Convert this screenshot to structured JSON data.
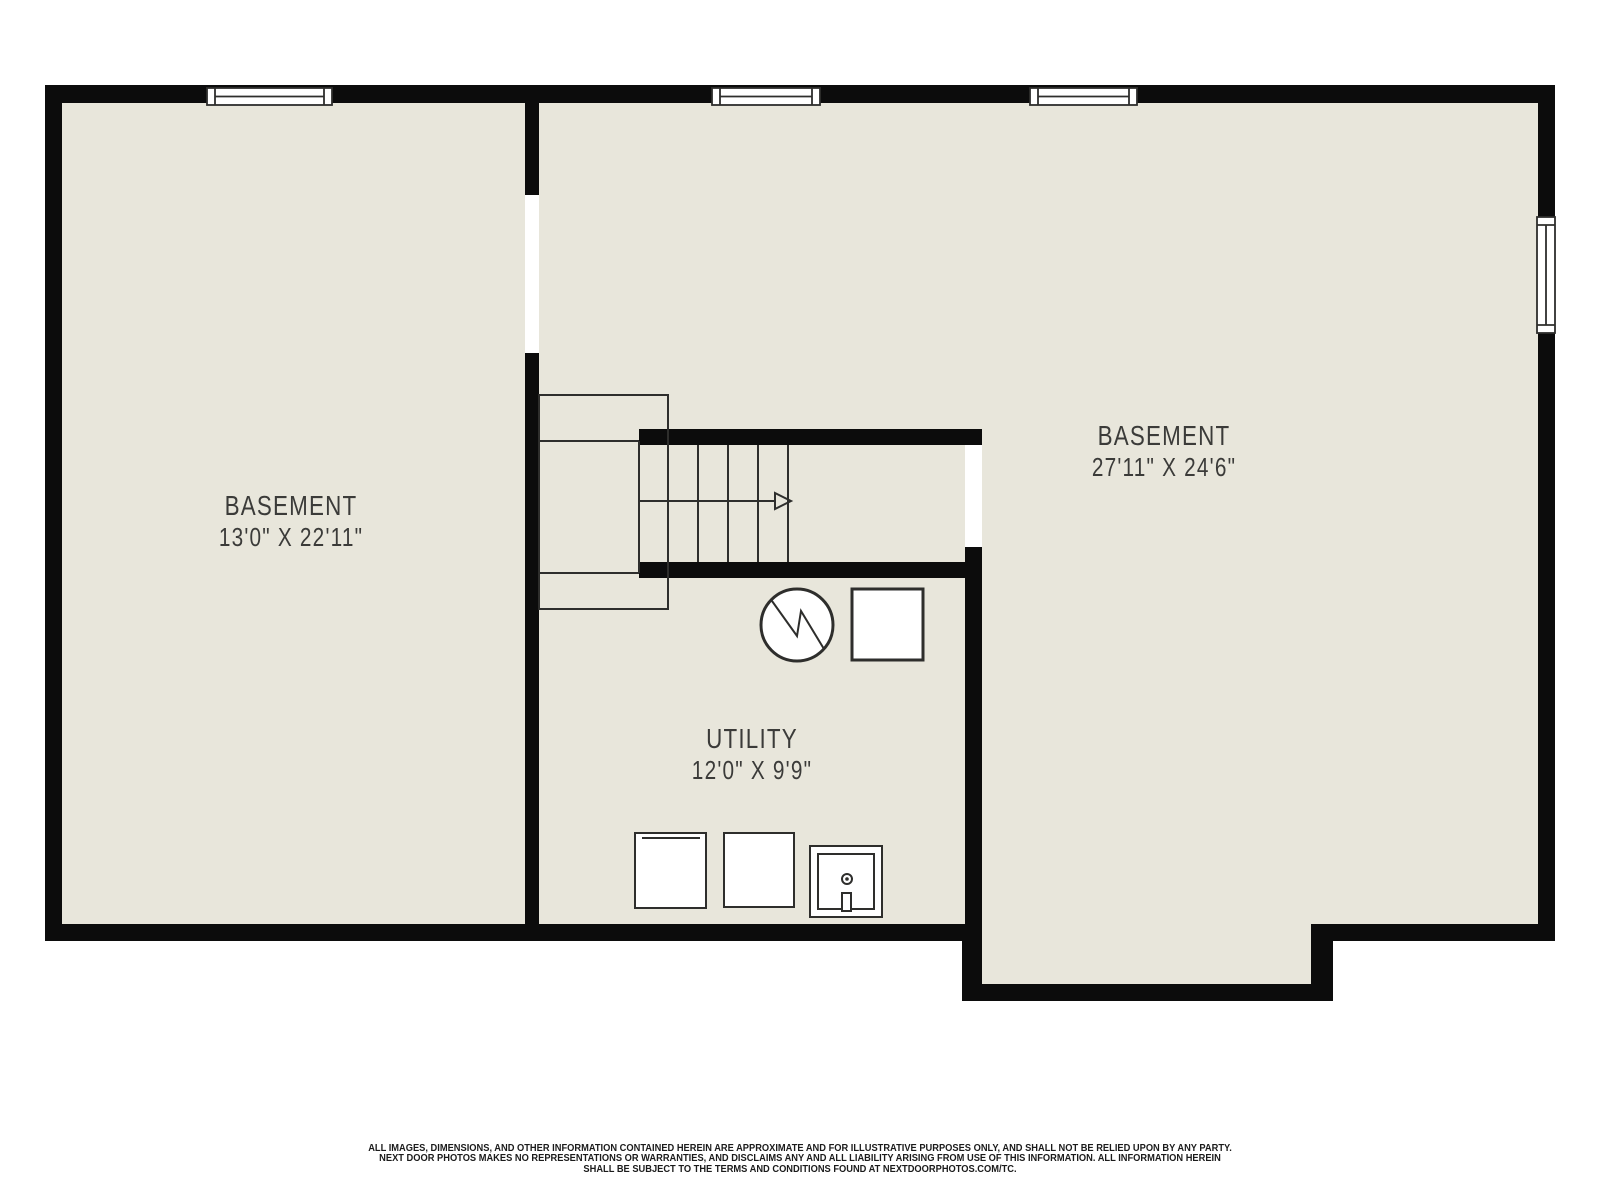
{
  "floorplan": {
    "title": "basement-floor-plan",
    "colors": {
      "floor": "#e8e6db",
      "wall": "#0c0c0c",
      "thin_line": "#2e2e2c",
      "label_text": "#3b3b39",
      "opening": "#ffffff",
      "background": "#ffffff"
    },
    "rooms": [
      {
        "id": "basement-left",
        "name": "BASEMENT",
        "dimensions": "13'0\" X 22'11\""
      },
      {
        "id": "basement-right",
        "name": "BASEMENT",
        "dimensions": "27'11\" X 24'6\""
      },
      {
        "id": "utility",
        "name": "UTILITY",
        "dimensions": "12'0\" X 9'9\""
      }
    ],
    "symbols": [
      "window-icon-top-left",
      "window-icon-top-middle",
      "window-icon-top-right",
      "window-icon-right-wall",
      "stairs-icon-with-up-arrow",
      "door-opening-left-wall",
      "door-opening-stair-landing",
      "water-heater-icon",
      "furnace-icon",
      "washer-icon",
      "dryer-icon",
      "utility-sink-icon"
    ]
  },
  "disclaimer": {
    "lines": [
      "ALL IMAGES, DIMENSIONS, AND OTHER INFORMATION CONTAINED HEREIN ARE APPROXIMATE AND FOR ILLUSTRATIVE PURPOSES ONLY, AND SHALL NOT BE RELIED UPON BY ANY PARTY.",
      "NEXT DOOR PHOTOS MAKES NO REPRESENTATIONS OR WARRANTIES, AND DISCLAIMS ANY AND ALL LIABILITY ARISING FROM USE OF THIS INFORMATION. ALL INFORMATION HEREIN",
      "SHALL BE SUBJECT TO THE TERMS AND CONDITIONS FOUND AT NEXTDOORPHOTOS.COM/TC."
    ]
  }
}
